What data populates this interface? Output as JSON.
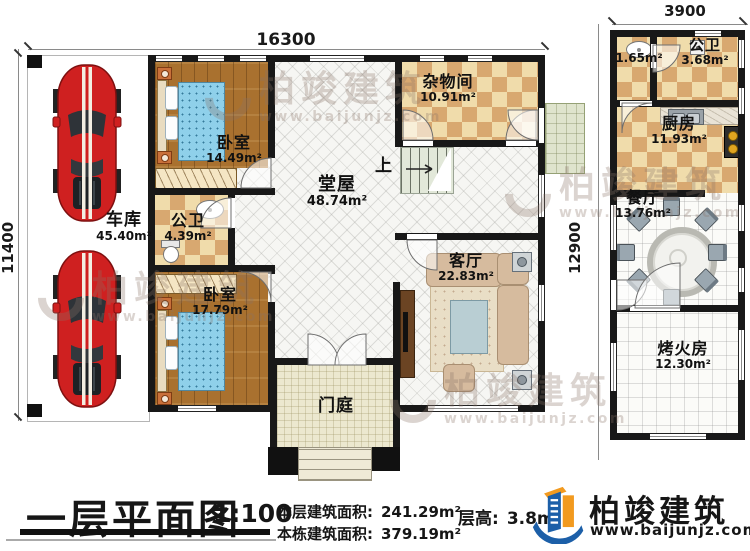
{
  "plan": {
    "title": "一层平面图",
    "scale": "1:100",
    "stats": [
      {
        "label": "本层建筑面积:",
        "value": "241.29m²"
      },
      {
        "label": "本栋建筑面积:",
        "value": "379.19m²"
      },
      {
        "label": "层高:",
        "value": "3.8m"
      }
    ]
  },
  "dimensions": {
    "top": "16300",
    "left": "11400",
    "annex_top": "3900",
    "annex_left": "12900"
  },
  "stairs": {
    "up_label": "上"
  },
  "rooms": [
    {
      "name": "车库",
      "area": "45.40m²"
    },
    {
      "name": "卧室",
      "area": "14.49m²"
    },
    {
      "name": "公卫",
      "area": "4.39m²"
    },
    {
      "name": "卧室",
      "area": "17.79m²"
    },
    {
      "name": "堂屋",
      "area": "48.74m²"
    },
    {
      "name": "杂物间",
      "area": "10.91m²"
    },
    {
      "name": "客厅",
      "area": "22.83m²"
    },
    {
      "name": "门庭",
      "area": ""
    },
    {
      "name": "",
      "area": "1.65m²"
    },
    {
      "name": "公卫",
      "area": "3.68m²"
    },
    {
      "name": "厨房",
      "area": "11.93m²"
    },
    {
      "name": "餐厅",
      "area": "13.76m²"
    },
    {
      "name": "烤火房",
      "area": "12.30m²"
    }
  ],
  "brand": {
    "name": "柏竣建筑",
    "url": "www.baijunjz.com"
  },
  "watermark": {
    "text": "柏竣建筑",
    "url": "www.baijunjz.com"
  },
  "colors": {
    "wall": "#181818",
    "wood_floor": "#a9712f",
    "checker_dark": "#d8a870",
    "checker_light": "#f0dcab",
    "bed_blue": "#8fd0ea",
    "car_red": "#cf2020",
    "brand_blue": "#1c5fa8",
    "brand_orange": "#f29a1f"
  }
}
